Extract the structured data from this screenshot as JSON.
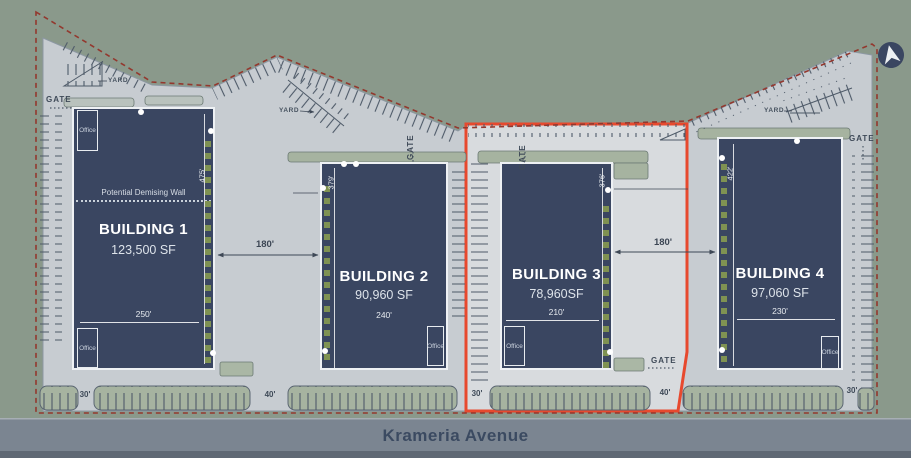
{
  "site": {
    "street_name": "Krameria Avenue",
    "boundary_color": "#93382e",
    "highlight_color": "#e7492e",
    "building_color": "#3a4661",
    "pavement_color": "#c7ccd1",
    "landscape_color": "#a6b3a0"
  },
  "buildings": [
    {
      "name": "BUILDING 1",
      "area": "123,500 SF",
      "depth": "475'",
      "width": "250'",
      "note": "Potential Demising Wall",
      "offices": [
        "Office",
        "Office"
      ]
    },
    {
      "name": "BUILDING 2",
      "area": "90,960 SF",
      "depth": "379'",
      "width": "240'",
      "offices": [
        "Office"
      ]
    },
    {
      "name": "BUILDING 3",
      "area": "78,960SF",
      "depth": "376'",
      "width": "210'",
      "offices": [
        "Office"
      ]
    },
    {
      "name": "BUILDING 4",
      "area": "97,060 SF",
      "depth": "422'",
      "width": "230'",
      "offices": [
        "Office"
      ]
    }
  ],
  "dimensions": {
    "bay_1_2": "180'",
    "bay_3_4": "180'",
    "drive_gaps": [
      "30'",
      "40'",
      "30'",
      "40'",
      "30'"
    ]
  },
  "labels": {
    "gate": "GATE",
    "yard": "YARD"
  }
}
